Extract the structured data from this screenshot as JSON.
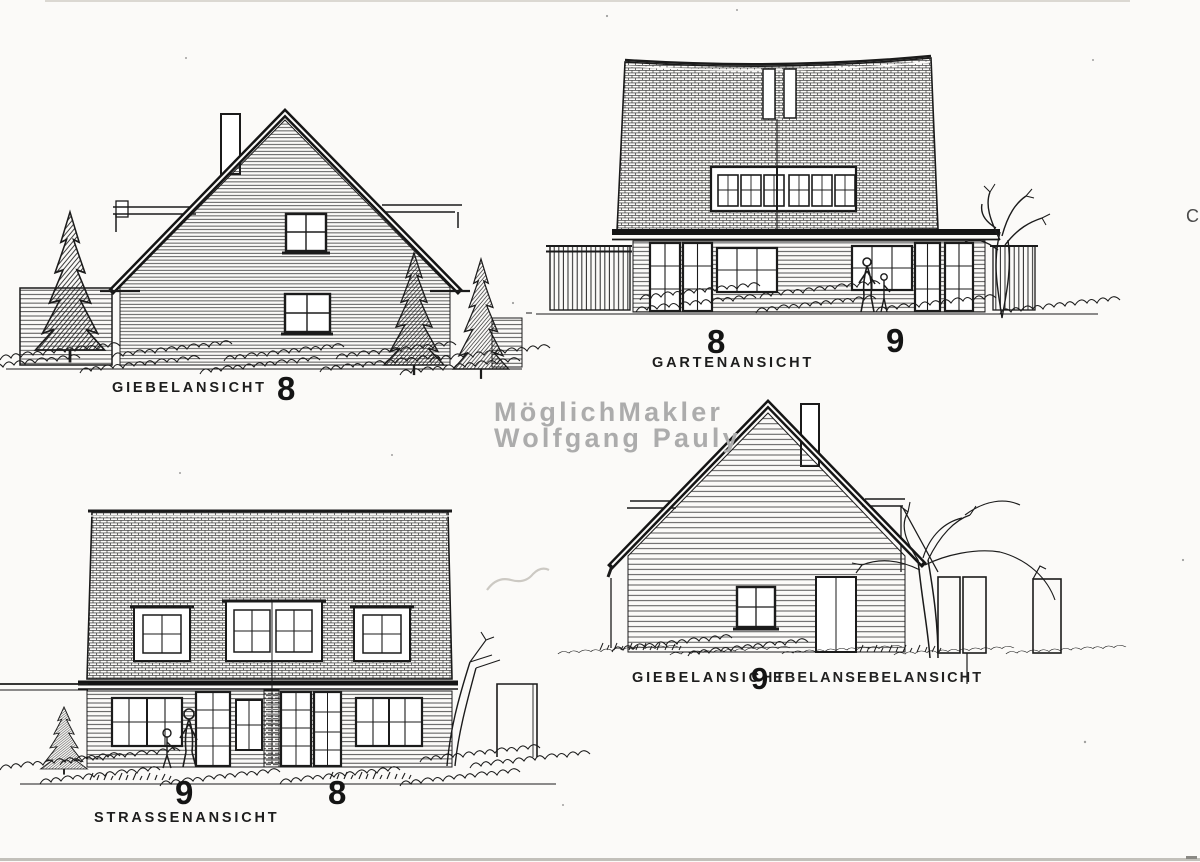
{
  "page": {
    "background": "#fbfaf8",
    "ink": "#1c1c1c",
    "watermark_color": "#acacac",
    "paper_edge_color": "#c2c0ba"
  },
  "watermark": {
    "line1": "MöglichMakler",
    "line2": "Wolfgang Pauly"
  },
  "views": {
    "gable_top_left": {
      "label": "GIEBELANSICHT",
      "number": "8"
    },
    "garden_top_right": {
      "label": "GARTENANSICHT",
      "number_left": "8",
      "number_right": "9"
    },
    "street_bottom_left": {
      "label": "STRASSENANSICHT",
      "number_left": "9",
      "number_right": "8"
    },
    "gable_bottom_right": {
      "label": "GIEBELANSICHT",
      "number": "9",
      "overlap_text": "EBELANSEBELANSICHT"
    }
  },
  "artifacts": {
    "edge_mark": "C"
  }
}
